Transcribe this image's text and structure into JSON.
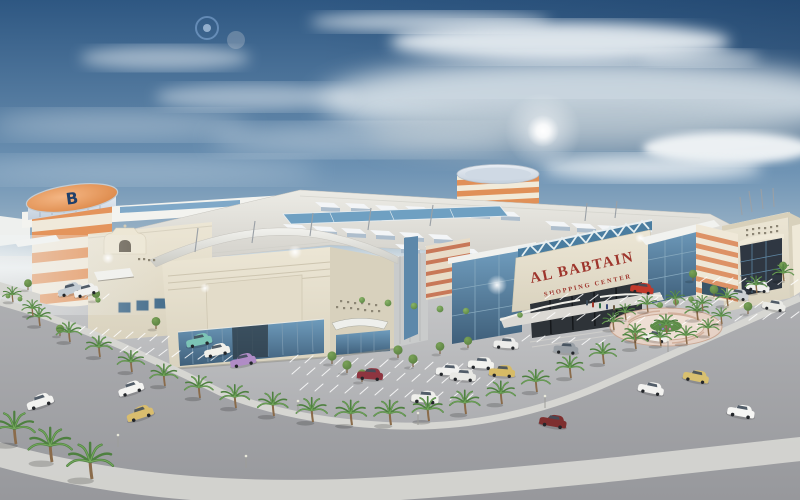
{
  "image": {
    "description": "Aerial architectural rendering of a shopping mall with striped tower, parking lots, palm trees and a curved road under a cloudy blue sky"
  },
  "sign": {
    "title": "AL BABTAIN",
    "subtitle": "SHOPPING CENTER"
  },
  "tower": {
    "logo_letter": "B"
  },
  "colors": {
    "sky_top": "#2e5782",
    "sky_mid": "#6e93b4",
    "sky_low": "#c9d5da",
    "cloud": "#e8eef2",
    "sun": "#ffffff",
    "ground": "#c6c7c9",
    "road": "#a2a3a7",
    "sidewalk": "#d6d6d2",
    "building_cream": "#ece6d5",
    "building_shadow": "#d8d1bd",
    "fascia_white": "#f2f2ee",
    "stripe_orange": "#e4945c",
    "metal_silver": "#c4d0dd",
    "glass_blue": "#5d88aa",
    "glass_dark": "#2e3338",
    "sign_red": "#9e352c",
    "truss_white": "#e6f0f2",
    "palm_green": "#4e8040",
    "palm_trunk": "#8a6b4a",
    "tree_green": "#7aa258",
    "plaza_pink": "#e6d2c6",
    "plaza_ring": "#cdab97"
  },
  "scene": {
    "palms": [
      [
        40,
        326,
        1
      ],
      [
        70,
        342,
        1.05
      ],
      [
        100,
        357,
        1.1
      ],
      [
        132,
        372,
        1.12
      ],
      [
        165,
        386,
        1.15
      ],
      [
        200,
        398,
        1.18
      ],
      [
        236,
        408,
        1.22
      ],
      [
        274,
        416,
        1.25
      ],
      [
        313,
        422,
        1.28
      ],
      [
        352,
        425,
        1.3
      ],
      [
        391,
        425,
        1.3
      ],
      [
        429,
        421,
        1.28
      ],
      [
        466,
        414,
        1.25
      ],
      [
        502,
        404,
        1.2
      ],
      [
        537,
        392,
        1.18
      ],
      [
        571,
        378,
        1.15
      ],
      [
        604,
        364,
        1.12
      ],
      [
        636,
        349,
        1.08
      ],
      [
        667,
        334,
        1.04
      ],
      [
        698,
        320,
        1
      ],
      [
        728,
        306,
        0.95
      ],
      [
        757,
        293,
        0.9
      ],
      [
        784,
        281,
        0.88
      ],
      [
        13,
        302,
        0.8
      ],
      [
        33,
        316,
        0.85
      ],
      [
        16,
        444,
        1.7
      ],
      [
        52,
        462,
        1.8
      ],
      [
        92,
        479,
        1.9
      ],
      [
        614,
        330,
        0.9
      ],
      [
        636,
        341,
        0.92
      ],
      [
        661,
        346,
        0.95
      ],
      [
        687,
        344,
        0.95
      ],
      [
        709,
        336,
        0.9
      ],
      [
        722,
        324,
        0.85
      ],
      [
        703,
        311,
        0.82
      ],
      [
        676,
        306,
        0.82
      ],
      [
        648,
        312,
        0.85
      ],
      [
        626,
        320,
        0.85
      ]
    ],
    "trees": [
      [
        332,
        364,
        1
      ],
      [
        347,
        373,
        1
      ],
      [
        362,
        382,
        1
      ],
      [
        398,
        358,
        1
      ],
      [
        413,
        367,
        1
      ],
      [
        440,
        354,
        0.95
      ],
      [
        468,
        348,
        0.9
      ],
      [
        96,
        301,
        0.9
      ],
      [
        156,
        329,
        0.95
      ],
      [
        60,
        336,
        0.9
      ],
      [
        714,
        297,
        0.95
      ],
      [
        748,
        314,
        0.95
      ],
      [
        783,
        273,
        0.9
      ],
      [
        693,
        281,
        0.9
      ],
      [
        28,
        290,
        0.85
      ]
    ],
    "shrubs": [
      [
        362,
        300,
        3
      ],
      [
        388,
        303,
        3.4
      ],
      [
        414,
        306,
        3.4
      ],
      [
        440,
        309,
        3.4
      ],
      [
        466,
        311,
        3.2
      ],
      [
        520,
        315,
        2.8
      ],
      [
        660,
        305,
        3
      ],
      [
        676,
        302,
        3
      ],
      [
        691,
        299,
        2.8
      ],
      [
        98,
        300,
        2.6
      ],
      [
        8,
        296,
        2.4
      ],
      [
        20,
        299,
        2.4
      ]
    ],
    "cars": [
      [
        70,
        290,
        "#c3ccd3",
        -15,
        0.95
      ],
      [
        86,
        291,
        "#f0f0ee",
        -15,
        0.95
      ],
      [
        199,
        341,
        "#7cc4b6",
        -12,
        1
      ],
      [
        217,
        351,
        "#f1f0ea",
        -12,
        1
      ],
      [
        243,
        361,
        "#b08cc6",
        -12,
        1
      ],
      [
        370,
        375,
        "#8e3540",
        4,
        1
      ],
      [
        425,
        398,
        "#efefeb",
        4,
        1.05
      ],
      [
        449,
        371,
        "#f1f1ef",
        4,
        1
      ],
      [
        463,
        376,
        "#e9e9e5",
        4,
        1
      ],
      [
        481,
        364,
        "#f2f2ee",
        4,
        1
      ],
      [
        502,
        372,
        "#d6bb66",
        4,
        1
      ],
      [
        506,
        344,
        "#ededeb",
        4,
        0.95
      ],
      [
        566,
        349,
        "#9aa0a6",
        4,
        0.95
      ],
      [
        642,
        289,
        "#c23a2c",
        8,
        0.9
      ],
      [
        655,
        337,
        "#f1f0ec",
        8,
        0.95
      ],
      [
        737,
        295,
        "#ccd0d4",
        10,
        0.9
      ],
      [
        758,
        287,
        "#f0f0ee",
        10,
        0.9
      ],
      [
        774,
        306,
        "#ebebe7",
        10,
        0.9
      ],
      [
        40,
        402,
        "#f2f2f0",
        -18,
        1.05
      ],
      [
        131,
        389,
        "#f4f4f2",
        -18,
        1
      ],
      [
        140,
        414,
        "#d9bd6e",
        -18,
        1.05
      ],
      [
        553,
        422,
        "#7e2f2f",
        10,
        1.05
      ],
      [
        651,
        389,
        "#f2f2f0",
        12,
        1
      ],
      [
        696,
        377,
        "#d8c070",
        12,
        1
      ],
      [
        741,
        412,
        "#f6f6f4",
        10,
        1.05
      ]
    ],
    "parking_rows": [
      [
        66,
        331,
        9,
        12,
        1.4,
        7,
        -6
      ],
      [
        120,
        352,
        9,
        13,
        1.2,
        8,
        -6
      ],
      [
        290,
        362,
        13,
        15,
        0.8,
        8,
        -7
      ],
      [
        292,
        374,
        14,
        15,
        0.9,
        8,
        -7
      ],
      [
        300,
        390,
        12,
        15,
        1.0,
        8,
        -7
      ],
      [
        545,
        299,
        15,
        15,
        0.6,
        8,
        -6
      ],
      [
        532,
        318,
        13,
        15,
        0.7,
        8,
        -6
      ],
      [
        522,
        341,
        6,
        15,
        0.9,
        8,
        -6
      ],
      [
        700,
        282,
        10,
        13,
        0.4,
        7,
        -5
      ],
      [
        58,
        295,
        6,
        9,
        0.8,
        6,
        -5
      ],
      [
        735,
        321,
        5,
        14,
        -0.8,
        8,
        -6
      ]
    ],
    "monitors": [
      [
        315,
        202
      ],
      [
        345,
        203
      ],
      [
        375,
        205
      ],
      [
        405,
        206
      ],
      [
        435,
        208
      ],
      [
        465,
        209
      ],
      [
        495,
        211
      ],
      [
        283,
        224
      ],
      [
        312,
        226
      ],
      [
        341,
        228
      ],
      [
        370,
        230
      ],
      [
        399,
        232
      ],
      [
        428,
        234
      ],
      [
        545,
        221
      ],
      [
        571,
        223
      ],
      [
        597,
        225
      ],
      [
        623,
        227
      ],
      [
        395,
        244
      ],
      [
        425,
        246
      ],
      [
        455,
        248
      ]
    ],
    "deco_dots": [
      [
        336,
        306
      ],
      [
        343,
        307
      ],
      [
        350,
        307
      ],
      [
        357,
        308
      ],
      [
        364,
        309
      ],
      [
        371,
        310
      ],
      [
        378,
        310
      ],
      [
        340,
        300
      ],
      [
        347,
        301
      ],
      [
        354,
        302
      ],
      [
        361,
        302
      ],
      [
        368,
        303
      ],
      [
        375,
        304
      ],
      [
        746,
        229
      ],
      [
        752,
        228
      ],
      [
        758,
        227
      ],
      [
        764,
        227
      ],
      [
        770,
        226
      ],
      [
        776,
        225
      ],
      [
        746,
        234
      ],
      [
        752,
        233
      ],
      [
        758,
        232
      ],
      [
        764,
        232
      ],
      [
        770,
        231
      ],
      [
        776,
        230
      ],
      [
        138,
        258
      ],
      [
        143,
        258
      ],
      [
        148,
        259
      ],
      [
        153,
        259
      ]
    ],
    "peds": [
      [
        586,
        300,
        "#3a4a58"
      ],
      [
        592,
        302,
        "#a03828"
      ],
      [
        599,
        303,
        "#2e6e46"
      ],
      [
        606,
        304,
        "#384a78"
      ],
      [
        613,
        305,
        "#6a5a42"
      ]
    ],
    "poles": [
      [
        195,
        252,
        198,
        228
      ],
      [
        252,
        243,
        255,
        221
      ],
      [
        310,
        236,
        313,
        213
      ],
      [
        368,
        230,
        371,
        208
      ],
      [
        430,
        226,
        433,
        205
      ],
      [
        585,
        221,
        587,
        203
      ],
      [
        615,
        218,
        617,
        201
      ],
      [
        752,
        212,
        749,
        191
      ],
      [
        763,
        209,
        761,
        189
      ],
      [
        774,
        207,
        773,
        188
      ],
      [
        742,
        215,
        740,
        197
      ]
    ],
    "lights": [
      [
        298,
        413
      ],
      [
        418,
        425
      ],
      [
        545,
        408
      ],
      [
        668,
        352
      ],
      [
        246,
        468
      ],
      [
        118,
        447
      ]
    ],
    "glints": [
      [
        108,
        258,
        6
      ],
      [
        295,
        252,
        7
      ],
      [
        497,
        285,
        10
      ],
      [
        640,
        238,
        5
      ],
      [
        205,
        288,
        5
      ]
    ]
  }
}
